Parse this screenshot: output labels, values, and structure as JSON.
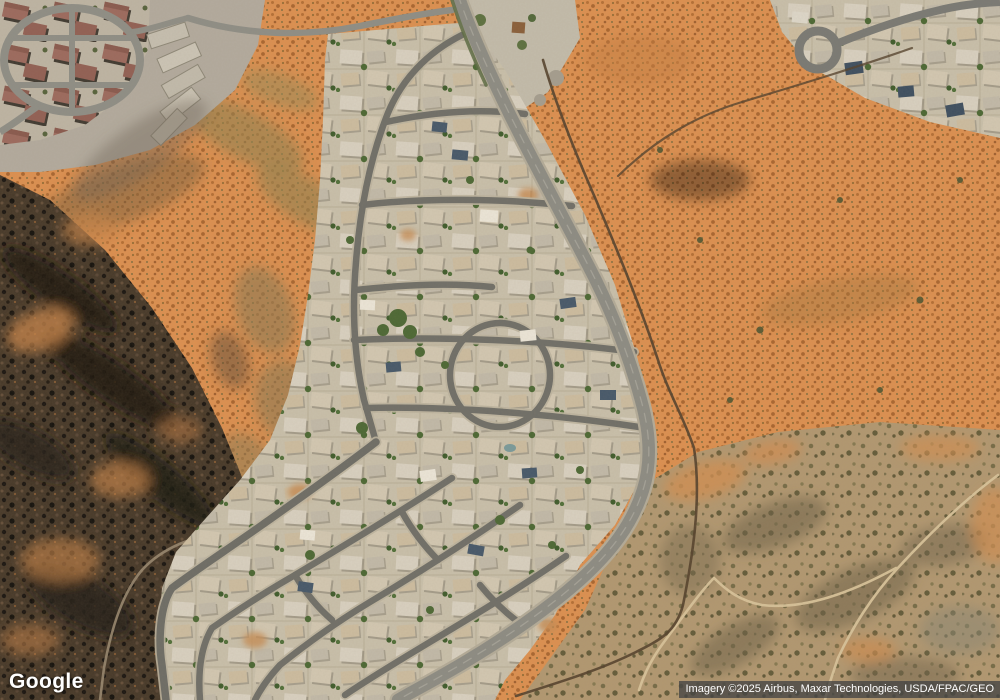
{
  "logo": {
    "text": "Google"
  },
  "attribution": {
    "text": "Imagery ©2025 Airbus, Maxar Technologies, USDA/FPAC/GEO"
  },
  "palette": {
    "desert_orange": "#dd9050",
    "desert_muted": "#b29871",
    "volcanic_dark": "#473929",
    "development_base": "#c9bfa9",
    "road_asphalt": "#8d8c84",
    "road_internal": "#706f68",
    "tree_green": "#4c6834",
    "trail_dark": "#54412c",
    "trail_light": "#d9c49b",
    "attribution_bg": "rgba(68,68,68,0.78)",
    "text_white": "#ffffff"
  }
}
